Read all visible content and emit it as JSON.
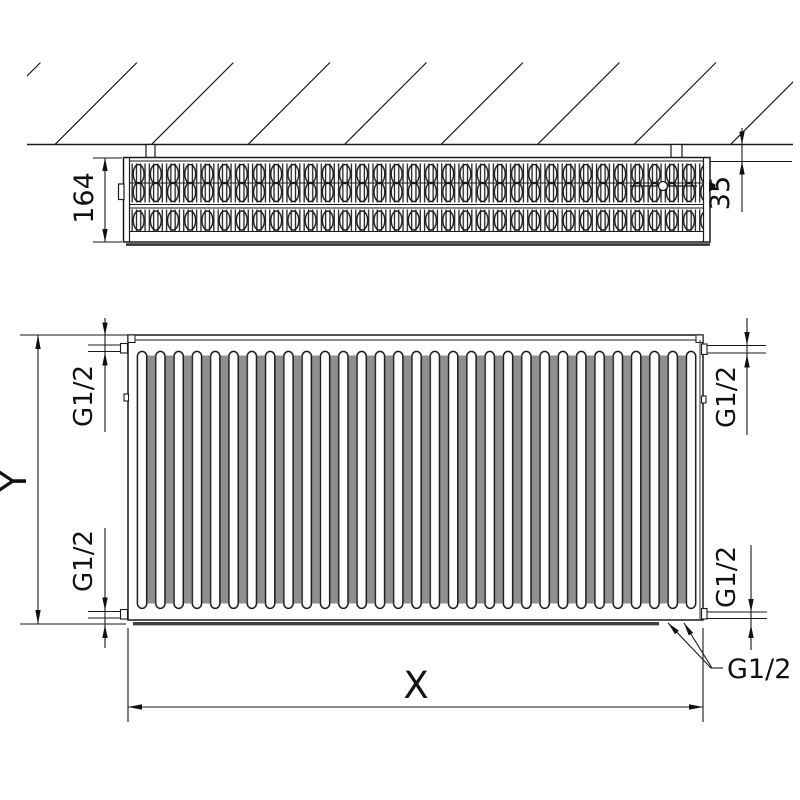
{
  "labels": {
    "top_view": {
      "depth": "164",
      "wall_clearance": "35"
    },
    "front_view": {
      "height": "Y",
      "width": "X",
      "thread_top_left": "G1/2",
      "thread_bottom_left": "G1/2",
      "thread_top_right": "G1/2",
      "thread_bottom_right": "G1/2",
      "thread_bottom_center": "G1/2"
    }
  }
}
